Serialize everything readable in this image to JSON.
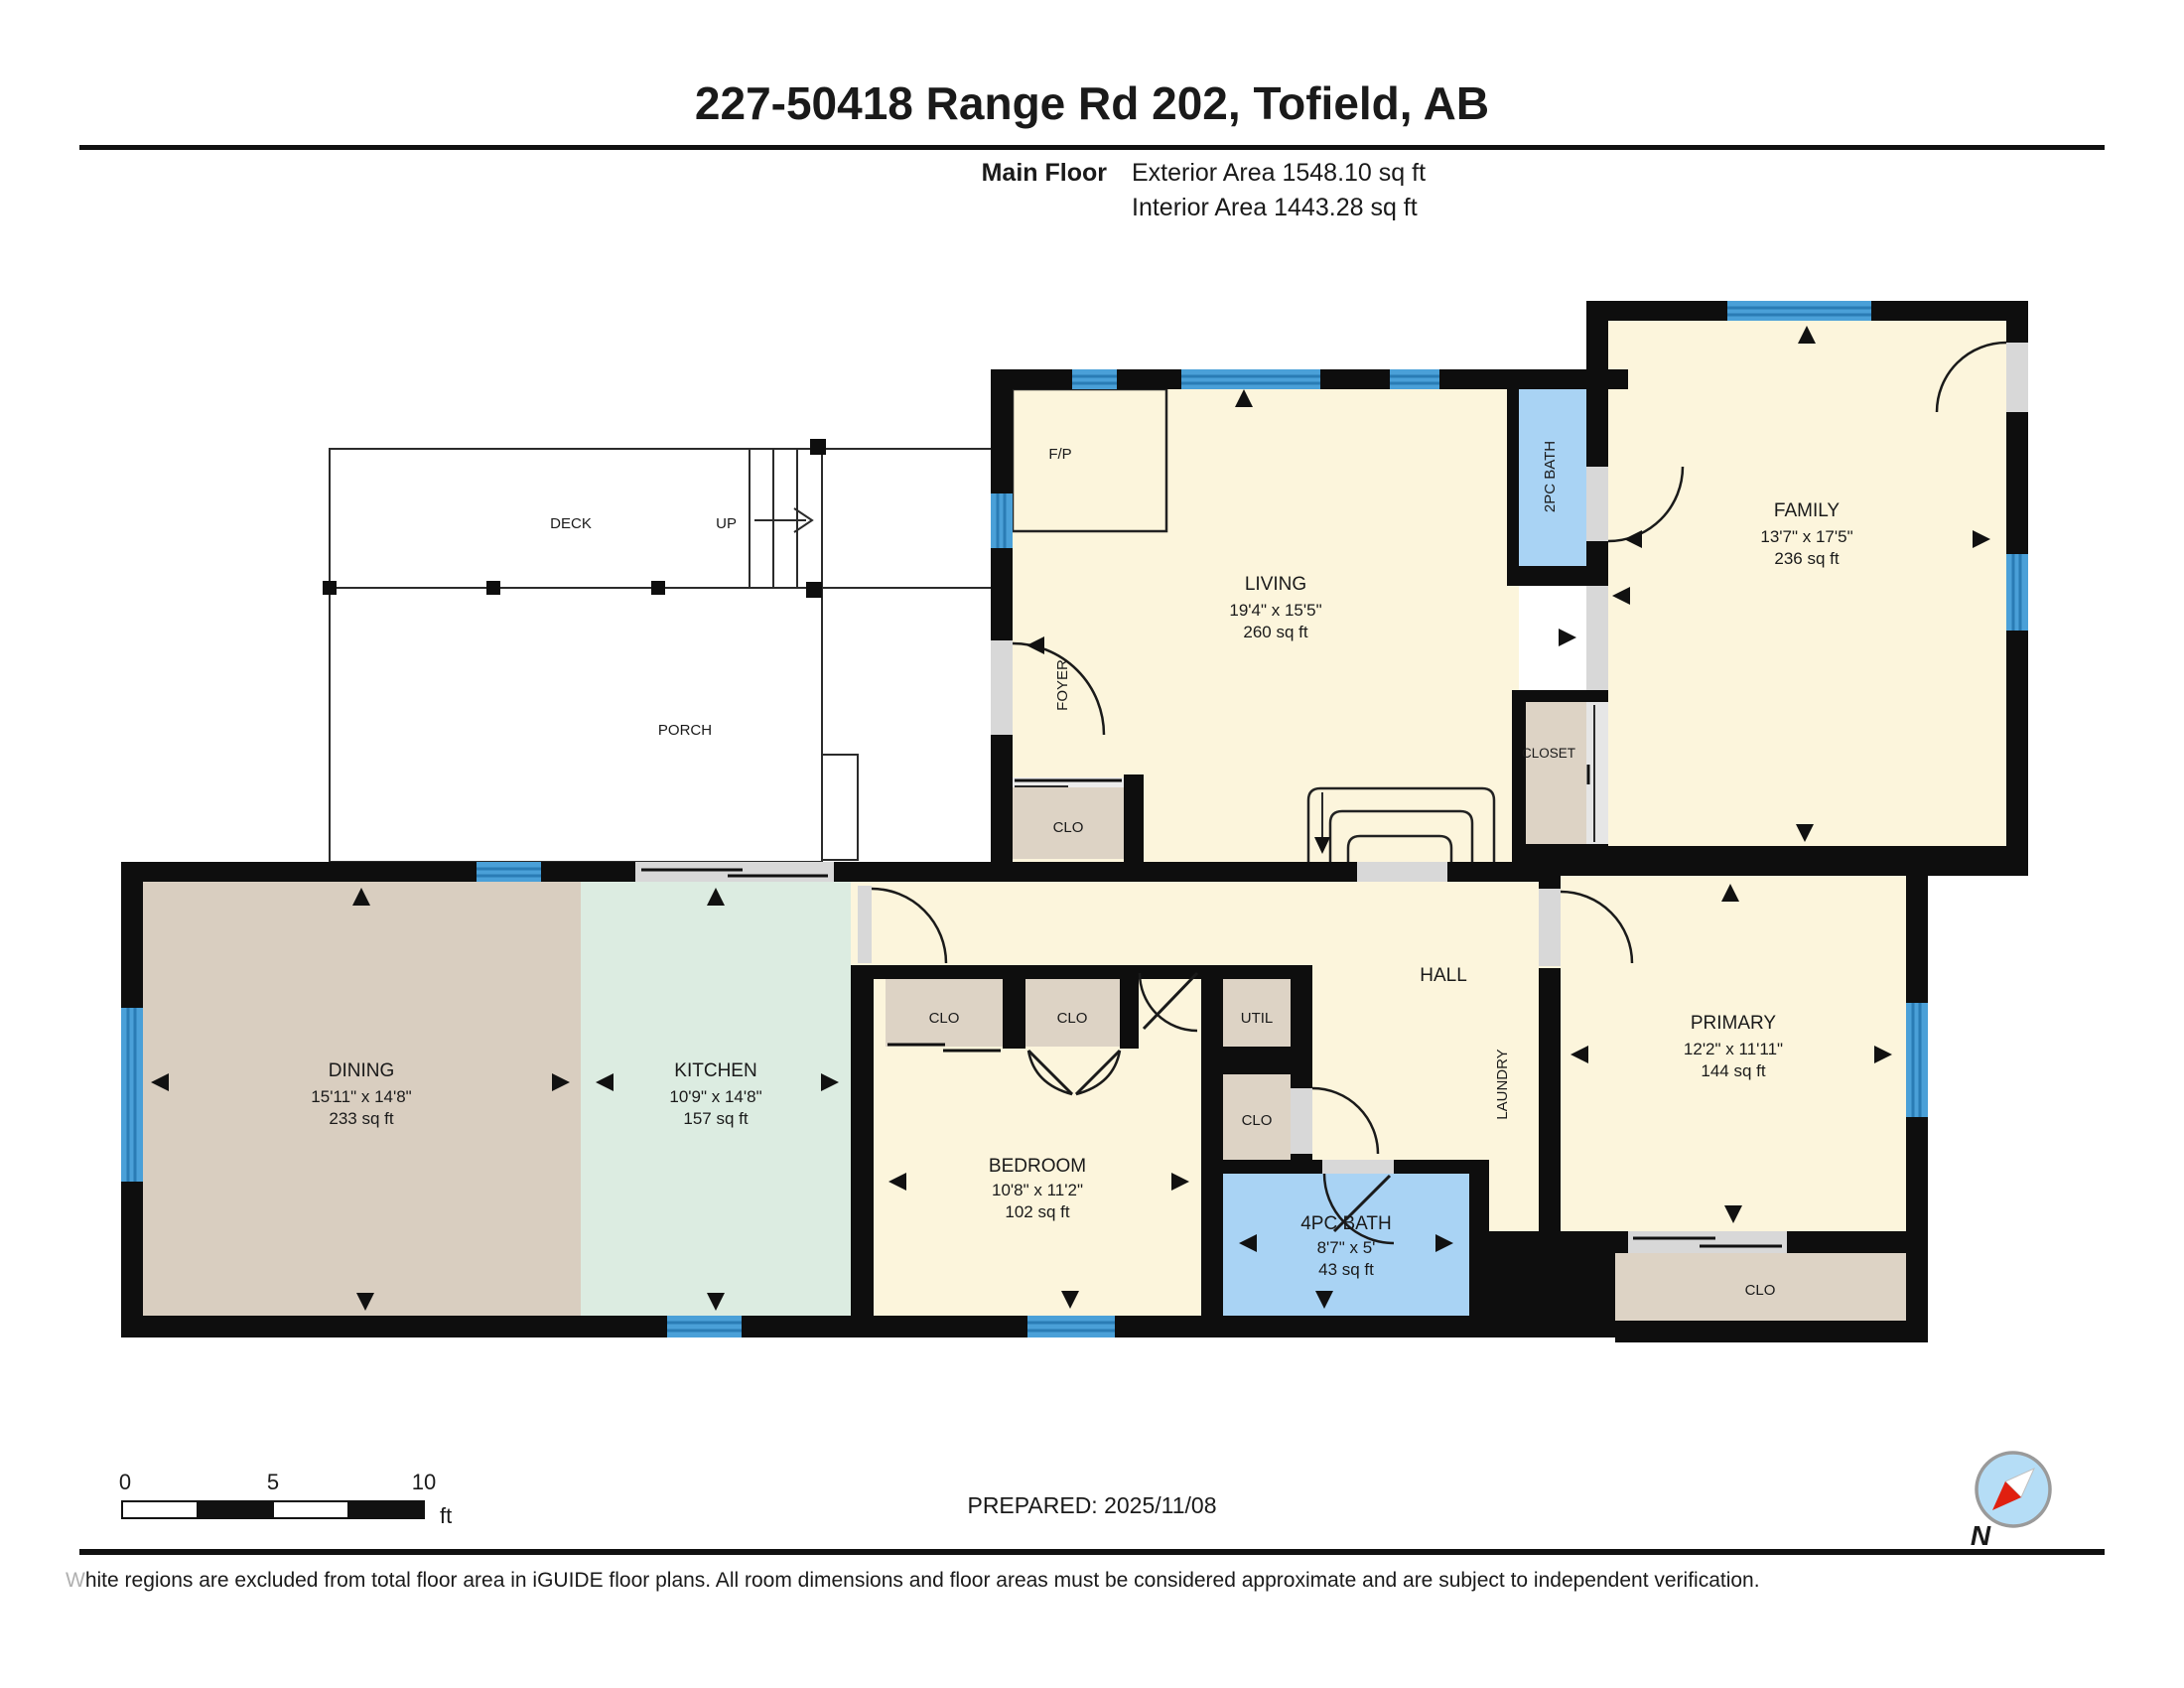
{
  "header": {
    "title": "227-50418 Range Rd 202, Tofield, AB",
    "floor_label": "Main Floor",
    "exterior_area": "Exterior Area 1548.10 sq ft",
    "interior_area": "Interior Area 1443.28 sq ft"
  },
  "rooms": {
    "living": {
      "name": "LIVING",
      "dims": "19'4\" x 15'5\"",
      "area": "260 sq ft"
    },
    "family": {
      "name": "FAMILY",
      "dims": "13'7\" x 17'5\"",
      "area": "236 sq ft"
    },
    "dining": {
      "name": "DINING",
      "dims": "15'11\" x 14'8\"",
      "area": "233 sq ft"
    },
    "kitchen": {
      "name": "KITCHEN",
      "dims": "10'9\" x 14'8\"",
      "area": "157 sq ft"
    },
    "bedroom": {
      "name": "BEDROOM",
      "dims": "10'8\" x 11'2\"",
      "area": "102 sq ft"
    },
    "primary": {
      "name": "PRIMARY",
      "dims": "12'2\" x 11'11\"",
      "area": "144 sq ft"
    },
    "bath4": {
      "name": "4PC BATH",
      "dims": "8'7\" x 5'",
      "area": "43 sq ft"
    },
    "bath2": {
      "name": "2PC BATH"
    },
    "hall": {
      "name": "HALL"
    },
    "laundry": {
      "name": "LAUNDRY"
    },
    "foyer": {
      "name": "FOYER"
    },
    "deck": {
      "name": "DECK"
    },
    "porch": {
      "name": "PORCH"
    },
    "fireplace": {
      "name": "F/P"
    },
    "up_label": "UP",
    "closet_small": "CLO",
    "closet_full": "CLOSET",
    "utility": "UTIL"
  },
  "footer": {
    "prepared": "PREPARED: 2025/11/08",
    "scale_ticks": [
      "0",
      "5",
      "10"
    ],
    "scale_unit": "ft",
    "compass_north": "N",
    "disclaimer_first": "W",
    "disclaimer_rest": "hite regions are excluded from total floor area in iGUIDE floor plans. All room dimensions and floor areas must be considered approximate and are subject to independent verification."
  },
  "colors": {
    "wall": "#0e0e0e",
    "floor": "#fcf5dc",
    "dining_floor": "#d9cec0",
    "kitchen_floor": "#dcece1",
    "bath_floor": "#a9d3f4",
    "closet_floor": "#ddd3c5",
    "window": "#4aa0d8",
    "opening": "#d8d8d8",
    "compass_red": "#e02010",
    "compass_blue": "#b5ddf6"
  }
}
